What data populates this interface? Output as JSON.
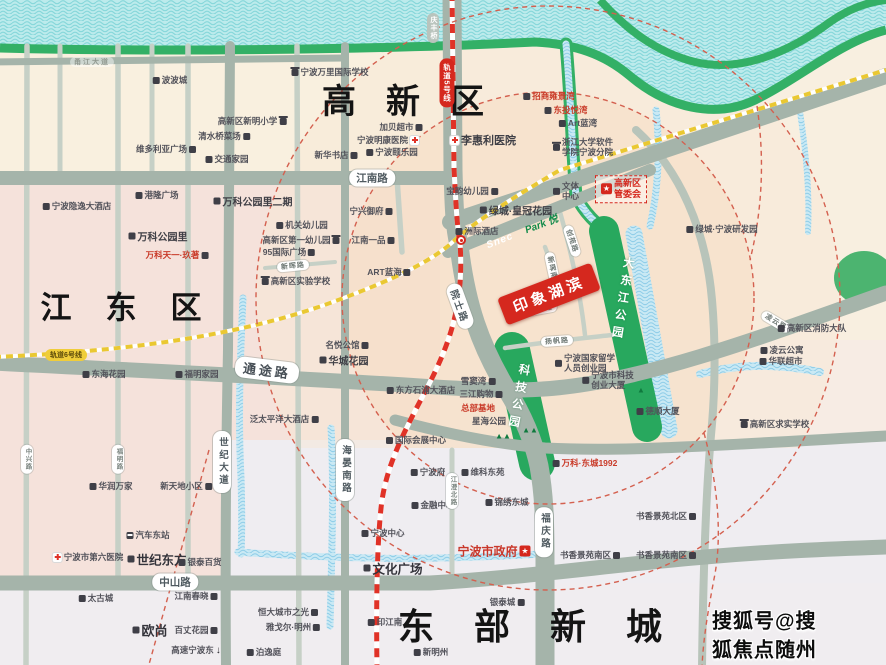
{
  "colors": {
    "land": "#f7ece4",
    "land_cream": "#f9f0df",
    "land_pink": "#f5e2db",
    "land_grey": "#efedf1",
    "peach_ring": "#f5dcc2",
    "road": "#a5b4aa",
    "road_minor": "#c6d0c6",
    "water": "#bcebec",
    "river_bank": "#33b066",
    "park": "#28a85e",
    "metro5": "#e03227",
    "metro6": "#eac832",
    "accent_red": "#d5281e",
    "boundary_red": "#d4604f"
  },
  "map": {
    "watermark": "搜狐号@搜狐焦点随州站",
    "project": {
      "name": "印象湖滨"
    },
    "rail_lines": [
      {
        "label": "轨道5号线"
      },
      {
        "label": "轨道6号线"
      }
    ],
    "labels": [
      {
        "t": "甬江大道",
        "x": 92,
        "y": 62,
        "cls": "roadfaint"
      },
      {
        "t": "波波城",
        "x": 170,
        "y": 80,
        "cls": "poi",
        "icon": "b",
        "ip": "l"
      },
      {
        "t": "宁波万里国际学校",
        "x": 330,
        "y": 72,
        "cls": "poi",
        "icon": "s",
        "ip": "l"
      },
      {
        "t": "高新区新明小学",
        "x": 252,
        "y": 121,
        "cls": "poi",
        "icon": "s",
        "ip": "r"
      },
      {
        "t": "清水桥菜场",
        "x": 224,
        "y": 136,
        "cls": "poi",
        "icon": "b",
        "ip": "r"
      },
      {
        "t": "维多利亚广场",
        "x": 166,
        "y": 149,
        "cls": "poi",
        "icon": "b",
        "ip": "r"
      },
      {
        "t": "交通家园",
        "x": 227,
        "y": 159,
        "cls": "poi",
        "icon": "b",
        "ip": "l"
      },
      {
        "t": "港隆广场",
        "x": 157,
        "y": 195,
        "cls": "poi",
        "icon": "b",
        "ip": "l"
      },
      {
        "t": "宁波隐逸大酒店",
        "x": 77,
        "y": 206,
        "cls": "poi",
        "icon": "b",
        "ip": "l"
      },
      {
        "t": "万科公园里二期",
        "x": 253,
        "y": 201,
        "cls": "pstrong",
        "icon": "b",
        "ip": "l"
      },
      {
        "t": "万科公园里",
        "x": 158,
        "y": 236,
        "cls": "pstrong",
        "icon": "b",
        "ip": "l"
      },
      {
        "t": "万科天一·玖著",
        "x": 177,
        "y": 255,
        "cls": "pred",
        "icon": "b",
        "ip": "r"
      },
      {
        "t": "高新区",
        "x": 418,
        "y": 102,
        "cls": "big",
        "fs": 34,
        "ls": 30
      },
      {
        "t": "加贝超市",
        "x": 401,
        "y": 127,
        "cls": "poi",
        "icon": "b",
        "ip": "r"
      },
      {
        "t": "宁波明康医院",
        "x": 388,
        "y": 140,
        "cls": "poi",
        "icon": "h",
        "ip": "r"
      },
      {
        "t": "宁波颐乐园",
        "x": 392,
        "y": 152,
        "cls": "poi",
        "icon": "b",
        "ip": "l"
      },
      {
        "t": "新华书店",
        "x": 336,
        "y": 155,
        "cls": "poi",
        "icon": "b",
        "ip": "r"
      },
      {
        "t": "李惠利医院",
        "x": 483,
        "y": 140,
        "cls": "pmed",
        "icon": "h",
        "ip": "l"
      },
      {
        "t": "江南路",
        "x": 372,
        "y": 178,
        "cls": "pill"
      },
      {
        "t": "宁兴御府",
        "x": 371,
        "y": 211,
        "cls": "poi",
        "icon": "b",
        "ip": "r"
      },
      {
        "t": "机关幼儿园",
        "x": 302,
        "y": 225,
        "cls": "poi",
        "icon": "b",
        "ip": "l"
      },
      {
        "t": "高新区第一幼儿园",
        "x": 301,
        "y": 240,
        "cls": "poi",
        "icon": "s",
        "ip": "r"
      },
      {
        "t": "95国际广场",
        "x": 289,
        "y": 252,
        "cls": "poi",
        "icon": "b",
        "ip": "r"
      },
      {
        "t": "新晖路",
        "x": 293,
        "y": 266,
        "cls": "pills",
        "rot": -6
      },
      {
        "t": "高新区实验学校",
        "x": 296,
        "y": 281,
        "cls": "poi",
        "icon": "s",
        "ip": "l"
      },
      {
        "t": "江南一品",
        "x": 373,
        "y": 240,
        "cls": "poi",
        "icon": "b",
        "ip": "r"
      },
      {
        "t": "ART蓝海",
        "x": 389,
        "y": 272,
        "cls": "poi",
        "icon": "b",
        "ip": "r"
      },
      {
        "t": "宝韵幼儿园",
        "x": 472,
        "y": 191,
        "cls": "poi",
        "icon": "b",
        "ip": "r"
      },
      {
        "t": "绿城·皇冠花园",
        "x": 516,
        "y": 210,
        "cls": "pstrong",
        "icon": "b",
        "ip": "l"
      },
      {
        "t": "洲际酒店",
        "x": 477,
        "y": 231,
        "cls": "poi",
        "icon": "b",
        "ip": "l"
      },
      {
        "t": "Snec",
        "x": 500,
        "y": 241,
        "cls": "snec",
        "rot": -21
      },
      {
        "t": "Park 悦",
        "x": 541,
        "y": 223,
        "cls": "parken",
        "rot": -21
      },
      {
        "t": "招商雍景湾",
        "x": 549,
        "y": 96,
        "cls": "pred",
        "icon": "b",
        "ip": "l"
      },
      {
        "t": "东投悦湾",
        "x": 566,
        "y": 110,
        "cls": "pred",
        "icon": "b",
        "ip": "l"
      },
      {
        "t": "Art蓝湾",
        "x": 578,
        "y": 123,
        "cls": "poi",
        "icon": "b",
        "ip": "l"
      },
      {
        "t": "浙江大学软件\n学院宁波分院",
        "x": 583,
        "y": 147,
        "cls": "poi2",
        "icon": "s",
        "ip": "l"
      },
      {
        "t": "文体\n中心",
        "x": 566,
        "y": 191,
        "cls": "poi2",
        "icon": "b",
        "ip": "l"
      },
      {
        "t": "高新区\n管委会",
        "x": 621,
        "y": 189,
        "cls": "boxred",
        "icon": "star",
        "ip": "l"
      },
      {
        "t": "绿城·宁波研发园",
        "x": 722,
        "y": 229,
        "cls": "poi",
        "icon": "b",
        "ip": "l"
      },
      {
        "t": "轨道5号线",
        "x": 447,
        "y": 83,
        "cls": "pillredv"
      },
      {
        "t": "庆丰桥",
        "x": 433,
        "y": 28,
        "cls": "pillgreyv"
      },
      {
        "t": "创苑路",
        "x": 572,
        "y": 241,
        "cls": "pills",
        "rot": 72
      },
      {
        "t": "新晖南路",
        "x": 553,
        "y": 272,
        "cls": "pills",
        "rot": 78
      },
      {
        "t": "院士路",
        "x": 460,
        "y": 306,
        "cls": "pillm",
        "rot": 70
      },
      {
        "t": "印象湖滨",
        "x": 549,
        "y": 294,
        "cls": "banner",
        "rot": -21,
        "name": "project-banner"
      },
      {
        "t": "文康路",
        "x": 541,
        "y": 309,
        "cls": "pills",
        "rot": -10
      },
      {
        "t": "大东江公园",
        "x": 622,
        "y": 300,
        "cls": "parkv",
        "rot": 9
      },
      {
        "t": "科技公园",
        "x": 518,
        "y": 398,
        "cls": "parkv",
        "rot": 11
      },
      {
        "t": "扬帆路",
        "x": 557,
        "y": 341,
        "cls": "pills",
        "rot": -4
      },
      {
        "t": "宁波国家留学\n人员创业园",
        "x": 585,
        "y": 363,
        "cls": "poi2",
        "icon": "b",
        "ip": "l"
      },
      {
        "t": "宁波市科技\n创业大厦",
        "x": 608,
        "y": 380,
        "cls": "poi2",
        "icon": "b",
        "ip": "l"
      },
      {
        "t": "东方石浦大酒店",
        "x": 421,
        "y": 390,
        "cls": "poi",
        "icon": "b",
        "ip": "l"
      },
      {
        "t": "雪窦湾",
        "x": 478,
        "y": 381,
        "cls": "poi",
        "icon": "b",
        "ip": "r"
      },
      {
        "t": "三江购物",
        "x": 481,
        "y": 394,
        "cls": "poi",
        "icon": "b",
        "ip": "r"
      },
      {
        "t": "总部基地",
        "x": 478,
        "y": 408,
        "cls": "pred"
      },
      {
        "t": "星海公园",
        "x": 489,
        "y": 421,
        "cls": "poi"
      },
      {
        "t": "▲▲",
        "x": 503,
        "y": 436,
        "cls": "trees",
        "name": "tree-icons"
      },
      {
        "t": "▲▲",
        "x": 530,
        "y": 430,
        "cls": "trees",
        "name": "tree-icons"
      },
      {
        "t": "▲",
        "x": 641,
        "y": 390,
        "cls": "trees",
        "name": "tree-icons"
      },
      {
        "t": "国际会展中心",
        "x": 416,
        "y": 440,
        "cls": "poi",
        "icon": "b",
        "ip": "l"
      },
      {
        "t": "泛太平洋大酒店",
        "x": 284,
        "y": 419,
        "cls": "poi",
        "icon": "b",
        "ip": "r"
      },
      {
        "t": "名悦公馆",
        "x": 347,
        "y": 345,
        "cls": "poi",
        "icon": "b",
        "ip": "r"
      },
      {
        "t": "华城花园",
        "x": 344,
        "y": 360,
        "cls": "pstrong",
        "icon": "b",
        "ip": "l"
      },
      {
        "t": "通途路",
        "x": 267,
        "y": 370,
        "cls": "pillb",
        "rot": 7
      },
      {
        "t": "轨道6号线",
        "x": 66,
        "y": 355,
        "cls": "pillyellow"
      },
      {
        "t": "江东区",
        "x": 138,
        "y": 308,
        "cls": "big",
        "fs": 31,
        "ls": 34
      },
      {
        "t": "东海花园",
        "x": 104,
        "y": 374,
        "cls": "poi",
        "icon": "b",
        "ip": "l"
      },
      {
        "t": "福明家园",
        "x": 197,
        "y": 374,
        "cls": "poi",
        "icon": "b",
        "ip": "l"
      },
      {
        "t": "华润万家",
        "x": 111,
        "y": 486,
        "cls": "poi",
        "icon": "b",
        "ip": "l"
      },
      {
        "t": "新天地小区",
        "x": 186,
        "y": 486,
        "cls": "poi",
        "icon": "b",
        "ip": "r"
      },
      {
        "t": "世纪大道",
        "x": 222,
        "y": 462,
        "cls": "pillv"
      },
      {
        "t": "福明路",
        "x": 118,
        "y": 459,
        "cls": "pillsv"
      },
      {
        "t": "中兴路",
        "x": 27,
        "y": 459,
        "cls": "pillsv"
      },
      {
        "t": "汽车东站",
        "x": 148,
        "y": 535,
        "cls": "poi",
        "icon": "bus",
        "ip": "l"
      },
      {
        "t": "宁波市第六医院",
        "x": 88,
        "y": 557,
        "cls": "poi",
        "icon": "h",
        "ip": "l"
      },
      {
        "t": "世纪东方",
        "x": 157,
        "y": 559,
        "cls": "pbig",
        "fs": 12.5,
        "icon": "b",
        "ip": "l"
      },
      {
        "t": "银泰百货",
        "x": 200,
        "y": 562,
        "cls": "poi",
        "icon": "b",
        "ip": "l"
      },
      {
        "t": "中山路",
        "x": 175,
        "y": 582,
        "cls": "pill"
      },
      {
        "t": "太古城",
        "x": 96,
        "y": 598,
        "cls": "poi",
        "icon": "b",
        "ip": "l"
      },
      {
        "t": "江南春晓",
        "x": 196,
        "y": 596,
        "cls": "poi",
        "icon": "b",
        "ip": "r"
      },
      {
        "t": "欧尚",
        "x": 150,
        "y": 630,
        "cls": "pbig",
        "fs": 13,
        "icon": "b",
        "ip": "l"
      },
      {
        "t": "百丈花园",
        "x": 196,
        "y": 630,
        "cls": "poi",
        "icon": "b",
        "ip": "r"
      },
      {
        "t": "高速宁波东",
        "x": 196,
        "y": 650,
        "cls": "poi",
        "icon": "down",
        "ip": "r"
      },
      {
        "t": "恒大城市之光",
        "x": 288,
        "y": 612,
        "cls": "poi",
        "icon": "b",
        "ip": "r"
      },
      {
        "t": "雅戈尔·明州",
        "x": 293,
        "y": 627,
        "cls": "poi",
        "icon": "b",
        "ip": "r"
      },
      {
        "t": "泊逸庭",
        "x": 264,
        "y": 652,
        "cls": "poi",
        "icon": "b",
        "ip": "l"
      },
      {
        "t": "海晏南路",
        "x": 345,
        "y": 470,
        "cls": "pillv"
      },
      {
        "t": "宁波府",
        "x": 428,
        "y": 472,
        "cls": "poi",
        "icon": "b",
        "ip": "l"
      },
      {
        "t": "维科东苑",
        "x": 483,
        "y": 472,
        "cls": "poi",
        "icon": "b",
        "ip": "l"
      },
      {
        "t": "金融中心",
        "x": 433,
        "y": 505,
        "cls": "poi",
        "icon": "b",
        "ip": "l"
      },
      {
        "t": "锦绣东城",
        "x": 507,
        "y": 502,
        "cls": "poi",
        "icon": "b",
        "ip": "l"
      },
      {
        "t": "宁波中心",
        "x": 383,
        "y": 533,
        "cls": "poi",
        "icon": "b",
        "ip": "l"
      },
      {
        "t": "宁波市政府",
        "x": 494,
        "y": 551,
        "cls": "predbig",
        "fs": 12,
        "icon": "star",
        "ip": "r"
      },
      {
        "t": "文化广场",
        "x": 393,
        "y": 568,
        "cls": "pbig",
        "fs": 12.5,
        "icon": "b",
        "ip": "l"
      },
      {
        "t": "印江南",
        "x": 385,
        "y": 622,
        "cls": "poi",
        "icon": "b",
        "ip": "l"
      },
      {
        "t": "新明州",
        "x": 431,
        "y": 652,
        "cls": "poi",
        "icon": "b",
        "ip": "l"
      },
      {
        "t": "东部新城",
        "x": 550,
        "y": 627,
        "cls": "big",
        "fs": 36,
        "ls": 40
      },
      {
        "t": "银泰城",
        "x": 507,
        "y": 602,
        "cls": "poi",
        "icon": "b",
        "ip": "r"
      },
      {
        "t": "万科·东城1992",
        "x": 585,
        "y": 463,
        "cls": "pred",
        "icon": "b",
        "ip": "l"
      },
      {
        "t": "福庆路",
        "x": 544,
        "y": 532,
        "cls": "pillv"
      },
      {
        "t": "书香景苑北区",
        "x": 666,
        "y": 516,
        "cls": "poi",
        "icon": "b",
        "ip": "r"
      },
      {
        "t": "书香景苑南区",
        "x": 590,
        "y": 555,
        "cls": "poi",
        "icon": "b",
        "ip": "r"
      },
      {
        "t": "书香景苑南区",
        "x": 666,
        "y": 555,
        "cls": "poi",
        "icon": "b",
        "ip": "r"
      },
      {
        "t": "凌云路",
        "x": 776,
        "y": 322,
        "cls": "pills",
        "rot": 31
      },
      {
        "t": "高新区消防大队",
        "x": 812,
        "y": 328,
        "cls": "poi",
        "icon": "b",
        "ip": "l"
      },
      {
        "t": "凌云公寓",
        "x": 782,
        "y": 350,
        "cls": "poi",
        "icon": "b",
        "ip": "l"
      },
      {
        "t": "华联超市",
        "x": 781,
        "y": 361,
        "cls": "poi",
        "icon": "b",
        "ip": "l"
      },
      {
        "t": "德顺大厦",
        "x": 658,
        "y": 411,
        "cls": "poi",
        "icon": "b",
        "ip": "l"
      },
      {
        "t": "高新区求实学校",
        "x": 775,
        "y": 424,
        "cls": "poi",
        "icon": "s",
        "ip": "l"
      },
      {
        "t": "江澄北路",
        "x": 452,
        "y": 491,
        "cls": "pillsv"
      },
      {
        "x": 461,
        "y": 240,
        "cls": "hubwrap",
        "icon": "hub",
        "name": "metro-interchange"
      },
      {
        "t": "搜狐号@搜狐焦点随州站",
        "x": 770,
        "y": 648,
        "cls": "wm",
        "name": "watermark"
      }
    ]
  }
}
